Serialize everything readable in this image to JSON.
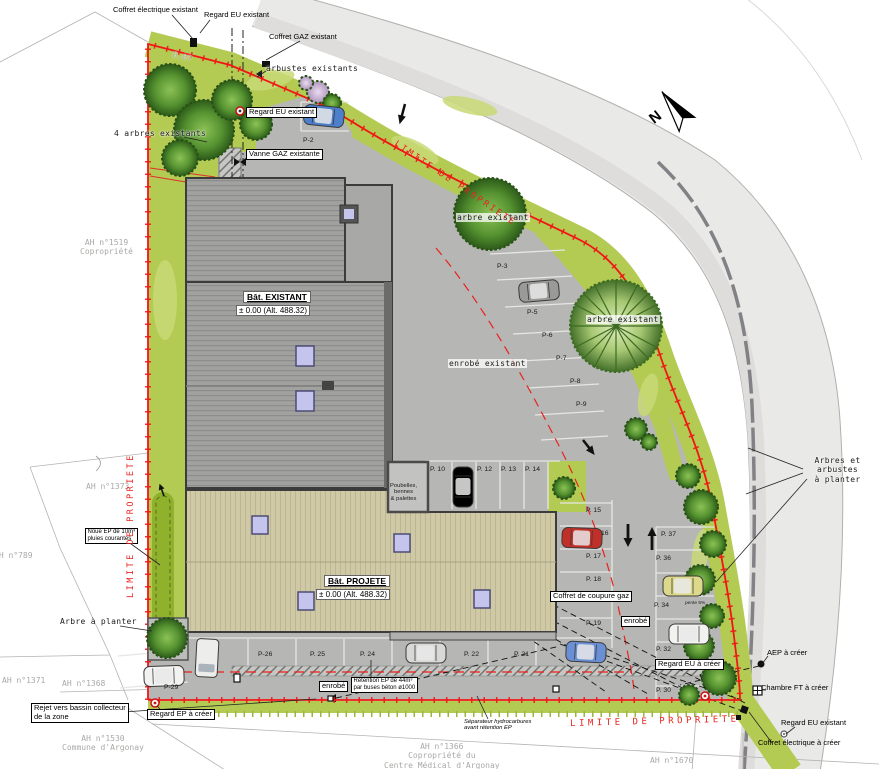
{
  "scene": {
    "width": 879,
    "height": 769,
    "type": "site-plan",
    "language": "fr"
  },
  "colors": {
    "lawn": "#b3cb52",
    "lawn_light": "#c9da77",
    "noue": "#8fb12c",
    "asphalt": "#b6b6b4",
    "road": "#e9e9e7",
    "sidewalk": "#dedddb",
    "roof_existing": "#a1a19f",
    "roof_projected": "#cfc9a6",
    "skylight": "#c4c4ec",
    "limit_red": "#f01616",
    "label_red": "#e8231f",
    "tree_dark": "#2c5a19"
  },
  "labels": [
    {
      "id": "coffret-electrique-existant-top",
      "t": "Coffret électrique existant",
      "x": 113,
      "y": 6,
      "k": "plain"
    },
    {
      "id": "regard-eu-existant-top",
      "t": "Regard EU existant",
      "x": 204,
      "y": 11,
      "k": "plain"
    },
    {
      "id": "coffret-gaz-existant",
      "t": "Coffret GAZ existant",
      "x": 269,
      "y": 33,
      "k": "plain"
    },
    {
      "id": "arbustes-existants",
      "t": "arbustes existants",
      "x": 266,
      "y": 64,
      "k": "sketch"
    },
    {
      "id": "quatre-arbres-existants",
      "t": "4 arbres existants",
      "x": 114,
      "y": 129,
      "k": "sketch"
    },
    {
      "id": "regard-eu-existant-box",
      "t": "Regard EU existant",
      "x": 246,
      "y": 107,
      "k": "boxed"
    },
    {
      "id": "vanne-gaz-existante",
      "t": "Vanne GAZ existante",
      "x": 246,
      "y": 149,
      "k": "boxed"
    },
    {
      "id": "dim-8-07",
      "t": "8.07",
      "x": 174,
      "y": 50,
      "k": "parcel",
      "rot": 14
    },
    {
      "id": "parcel-ah-1519",
      "t": "AH n°1519\nCopropriété",
      "x": 80,
      "y": 238,
      "k": "parcel",
      "ctr": true
    },
    {
      "id": "parcel-ah-1373",
      "t": "AH n°1373",
      "x": 86,
      "y": 482,
      "k": "parcel"
    },
    {
      "id": "parcel-ah-789",
      "t": "AH n°789",
      "x": -6,
      "y": 551,
      "k": "parcel"
    },
    {
      "id": "parcel-ah-1371",
      "t": "AH n°1371",
      "x": 2,
      "y": 676,
      "k": "parcel"
    },
    {
      "id": "parcel-ah-1368",
      "t": "AH n°1368",
      "x": 62,
      "y": 679,
      "k": "parcel"
    },
    {
      "id": "parcel-ah-1530",
      "t": "AH n°1530\nCommune d'Argonay",
      "x": 62,
      "y": 734,
      "k": "parcel",
      "ctr": true
    },
    {
      "id": "parcel-ah-1366",
      "t": "AH n°1366\nCopropriété du\nCentre Médical d'Argonay",
      "x": 384,
      "y": 742,
      "k": "parcel",
      "ctr": true
    },
    {
      "id": "parcel-ah-1670",
      "t": "AH n°1670",
      "x": 650,
      "y": 756,
      "k": "parcel"
    },
    {
      "id": "bat-existant-name",
      "t": "Bât. EXISTANT",
      "x": 243,
      "y": 291,
      "k": "bname"
    },
    {
      "id": "bat-existant-alt",
      "t": "± 0.00 (Alt. 488.32)",
      "x": 236,
      "y": 305,
      "k": "balt"
    },
    {
      "id": "bat-projete-name",
      "t": "Bât. PROJETE",
      "x": 324,
      "y": 575,
      "k": "bname"
    },
    {
      "id": "bat-projete-alt",
      "t": "± 0.00 (Alt. 488.32)",
      "x": 316,
      "y": 589,
      "k": "balt"
    },
    {
      "id": "arbre-existant-1",
      "t": "arbre existant",
      "x": 456,
      "y": 213,
      "k": "sketchhalo"
    },
    {
      "id": "arbre-existant-2",
      "t": "arbre existant",
      "x": 586,
      "y": 315,
      "k": "sketchhalo"
    },
    {
      "id": "enrobe-existant",
      "t": "enrobé existant",
      "x": 448,
      "y": 359,
      "k": "sketchhalo"
    },
    {
      "id": "poubelles-bennes-palettes",
      "t": "Poubelles,\nbennes\n& palettes",
      "x": 390,
      "y": 483,
      "k": "tinyc"
    },
    {
      "id": "coffret-de-coupure-gaz",
      "t": "Coffret de coupure gaz",
      "x": 550,
      "y": 591,
      "k": "boxed"
    },
    {
      "id": "enrobe-lane",
      "t": "enrobé",
      "x": 621,
      "y": 616,
      "k": "boxed"
    },
    {
      "id": "enrobe-bottom",
      "t": "enrobé",
      "x": 319,
      "y": 681,
      "k": "boxed"
    },
    {
      "id": "retention-ep",
      "t": "Rétention EP de 44m³\npar buses béton ø1000",
      "x": 351,
      "y": 677,
      "k": "boxtiny"
    },
    {
      "id": "separateur-hydrocarbures",
      "t": "Séparateur hydrocarbures\navant rétention EP",
      "x": 464,
      "y": 719,
      "k": "tinyi"
    },
    {
      "id": "regard-ep-a-creer",
      "t": "Regard EP à créer",
      "x": 147,
      "y": 709,
      "k": "boxed"
    },
    {
      "id": "rejet-vers-bassin",
      "t": "Rejet vers bassin collecteur\nde la zone",
      "x": 31,
      "y": 703,
      "k": "boxed"
    },
    {
      "id": "regard-eu-a-creer",
      "t": "Regard EU à créer",
      "x": 655,
      "y": 659,
      "k": "boxed"
    },
    {
      "id": "aep-a-creer",
      "t": "AEP à créer",
      "x": 767,
      "y": 649,
      "k": "plain"
    },
    {
      "id": "chambre-ft-a-creer",
      "t": "Chambre FT à créer",
      "x": 761,
      "y": 684,
      "k": "plain"
    },
    {
      "id": "regard-eu-existant-br",
      "t": "Regard EU existant",
      "x": 781,
      "y": 719,
      "k": "plain"
    },
    {
      "id": "coffret-electrique-a-creer",
      "t": "Coffret électrique à créer",
      "x": 758,
      "y": 739,
      "k": "plain"
    },
    {
      "id": "arbre-a-planter",
      "t": "Arbre à planter",
      "x": 60,
      "y": 617,
      "k": "sketch"
    },
    {
      "id": "arbres-et-arbustes-a-planter",
      "t": "Arbres et arbustes\nà planter",
      "x": 796,
      "y": 456,
      "k": "sketch",
      "ctr": true
    },
    {
      "id": "noue-ep",
      "t": "Noue EP de 10m³\npluies courantes",
      "x": 85,
      "y": 528,
      "k": "boxtiny"
    },
    {
      "id": "limite-de-propriete-left",
      "t": "LIMITE DE PROPRIETE",
      "x": 126,
      "y": 598,
      "k": "limit",
      "rot": -90
    },
    {
      "id": "limite-de-propriete-top",
      "t": "LIMITE DE PROPRIETE",
      "x": 398,
      "y": 139,
      "k": "limit",
      "rot": 34
    },
    {
      "id": "limite-de-propriete-bottom",
      "t": "LIMITE DE PROPRIETE",
      "x": 570,
      "y": 719,
      "k": "limitw",
      "rot": -1.5
    },
    {
      "id": "north-letter",
      "t": "N",
      "x": 646,
      "y": 114,
      "k": "north",
      "rot": -38
    },
    {
      "id": "pente-5",
      "t": "pente 5%",
      "x": 685,
      "y": 601,
      "k": "tiny"
    }
  ],
  "parking": [
    {
      "t": "P-2",
      "x": 303,
      "y": 137
    },
    {
      "t": "P-3",
      "x": 497,
      "y": 263
    },
    {
      "t": "P-5",
      "x": 527,
      "y": 309
    },
    {
      "t": "P-6",
      "x": 542,
      "y": 332
    },
    {
      "t": "P-7",
      "x": 556,
      "y": 355
    },
    {
      "t": "P-8",
      "x": 570,
      "y": 378
    },
    {
      "t": "P-9",
      "x": 576,
      "y": 401
    },
    {
      "t": "P. 10",
      "x": 430,
      "y": 466
    },
    {
      "t": "P. 12",
      "x": 477,
      "y": 466
    },
    {
      "t": "P. 13",
      "x": 501,
      "y": 466
    },
    {
      "t": "P. 14",
      "x": 525,
      "y": 466
    },
    {
      "t": "P. 15",
      "x": 586,
      "y": 507
    },
    {
      "t": "16",
      "x": 601,
      "y": 530
    },
    {
      "t": "P. 17",
      "x": 586,
      "y": 553
    },
    {
      "t": "P. 18",
      "x": 586,
      "y": 576
    },
    {
      "t": "P. 19",
      "x": 586,
      "y": 620
    },
    {
      "t": "P. 21",
      "x": 514,
      "y": 651
    },
    {
      "t": "P. 22",
      "x": 464,
      "y": 651
    },
    {
      "t": "P. 24",
      "x": 360,
      "y": 651
    },
    {
      "t": "P. 25",
      "x": 310,
      "y": 651
    },
    {
      "t": "P-26",
      "x": 258,
      "y": 651
    },
    {
      "t": "P-29",
      "x": 164,
      "y": 684
    },
    {
      "t": "P. 30",
      "x": 656,
      "y": 687
    },
    {
      "t": "P. 32",
      "x": 656,
      "y": 646
    },
    {
      "t": "P. 34",
      "x": 654,
      "y": 602
    },
    {
      "t": "P. 36",
      "x": 656,
      "y": 555
    },
    {
      "t": "P. 37",
      "x": 661,
      "y": 531
    }
  ]
}
